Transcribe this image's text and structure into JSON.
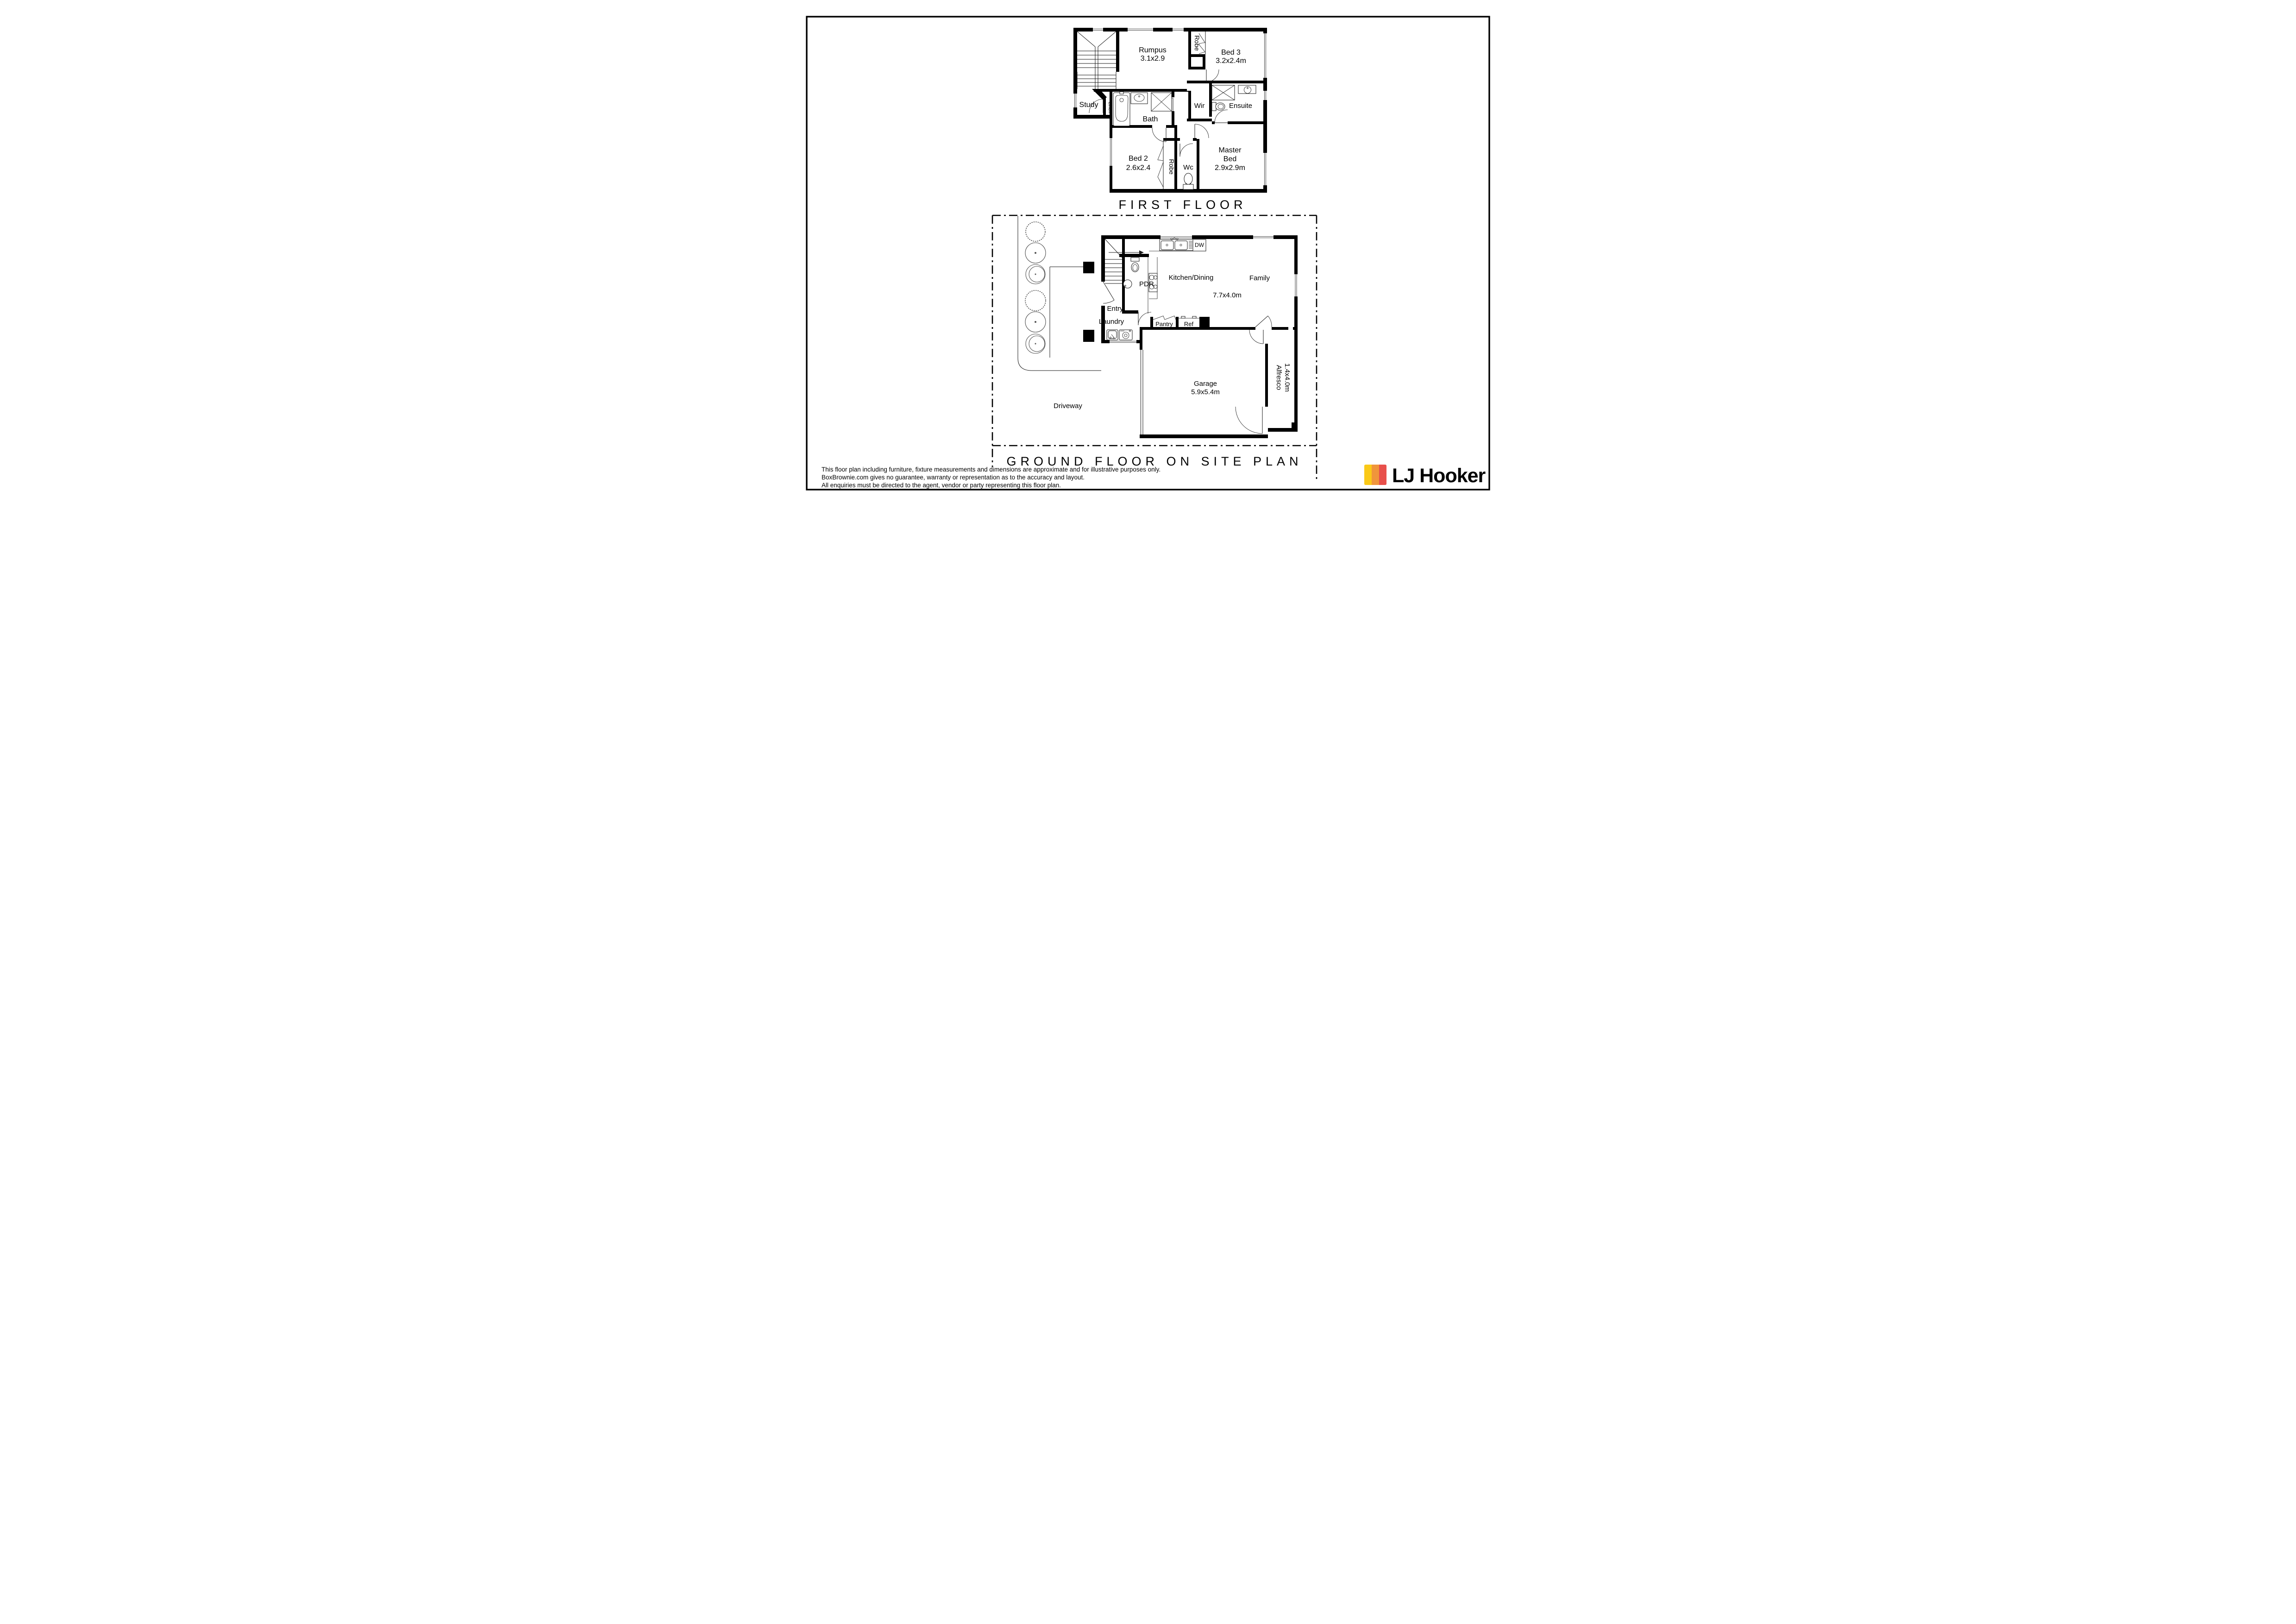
{
  "first_floor": {
    "title": "FIRST FLOOR",
    "rumpus": {
      "name": "Rumpus",
      "dims": "3.1x2.9"
    },
    "bed3": {
      "name": "Bed 3",
      "dims": "3.2x2.4m",
      "robe": "Robe"
    },
    "study": "Study",
    "linen": "Linen",
    "bath": "Bath",
    "wir": "Wir",
    "ensuite": "Ensuite",
    "bed2": {
      "name": "Bed 2",
      "dims": "2.6x2.4",
      "robe": "Robe"
    },
    "wc": "Wc",
    "master": {
      "line1": "Master",
      "line2": "Bed",
      "dims": "2.9x2.9m"
    }
  },
  "ground_floor": {
    "title": "GROUND FLOOR ON SITE PLAN",
    "kitchen_dining": "Kitchen/Dining",
    "family": "Family",
    "living_dims": "7.7x4.0m",
    "pdr": "PDR",
    "entry": "Entry",
    "laundry": "Laundry",
    "pantry": "Pantry",
    "ref": "Ref",
    "dw": "DW",
    "garage": {
      "name": "Garage",
      "dims": "5.9x5.4m"
    },
    "alfresco": {
      "name": "Alfresco",
      "dims": "1.4x4.0m"
    },
    "driveway": "Driveway"
  },
  "disclaimer": {
    "line1": "This floor plan including furniture, fixture measurements and dimensions are approximate and for illustrative purposes only.",
    "line2": "BoxBrownie.com gives no guarantee, warranty or representation as to the accuracy and layout.",
    "line3": "All enquiries must be directed to the agent, vendor or party representing this floor plan.",
    "color": "#000000"
  },
  "logo": {
    "brand": "LJ Hooker",
    "colors": {
      "yellow": "#FAC917",
      "orange": "#F0953B",
      "red": "#E8504B",
      "text": "#050505"
    }
  }
}
